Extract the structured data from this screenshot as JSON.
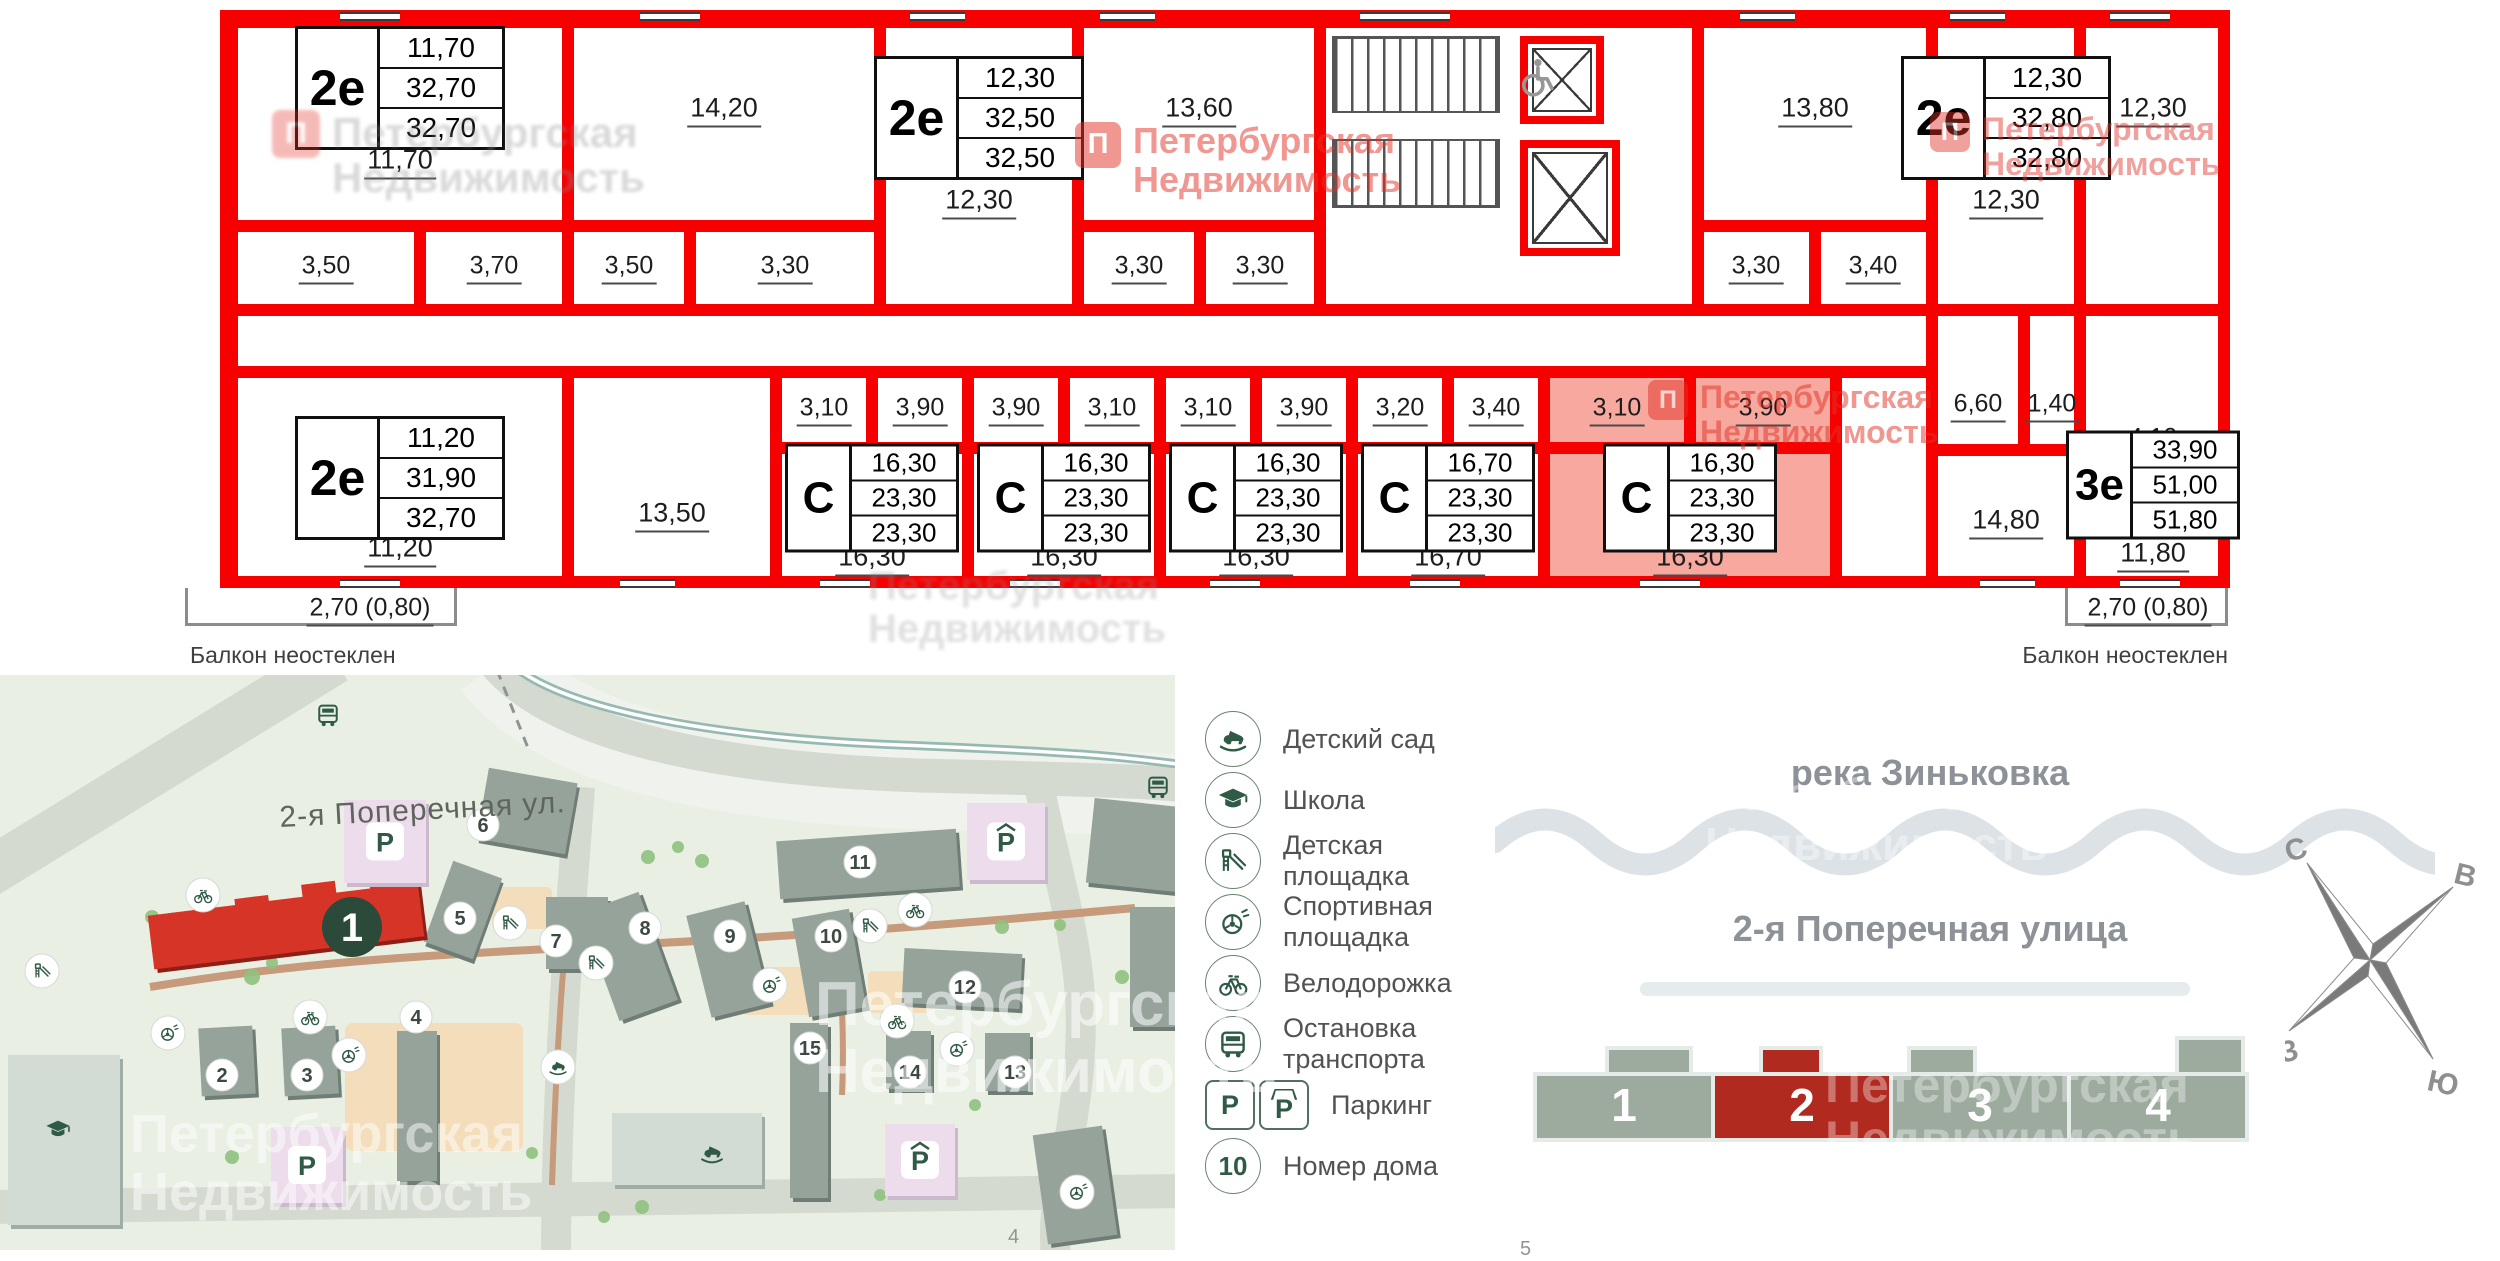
{
  "watermark": {
    "line1": "Петербургская",
    "line2": "Недвижимость",
    "logo_letter": "П"
  },
  "watermarks": [
    {
      "x": 1075,
      "y": 122,
      "style": "red",
      "size": 36,
      "logo": 46,
      "opacity": 0.5
    },
    {
      "x": 1930,
      "y": 112,
      "style": "red",
      "size": 32,
      "logo": 40,
      "opacity": 0.45
    },
    {
      "x": 1648,
      "y": 380,
      "style": "red",
      "size": 32,
      "logo": 40,
      "opacity": 0.5
    },
    {
      "x": 272,
      "y": 110,
      "style": "gray",
      "size": 42,
      "logo": 48,
      "opacity": 0.33
    },
    {
      "x": 868,
      "y": 565,
      "style": "gray",
      "size": 40,
      "logo": 0,
      "opacity": 0.27
    },
    {
      "x": 815,
      "y": 972,
      "style": "white",
      "size": 62,
      "logo": 0,
      "opacity": 0.55
    },
    {
      "x": 130,
      "y": 1105,
      "style": "white",
      "size": 54,
      "logo": 0,
      "opacity": 0.5
    },
    {
      "x": 1705,
      "y": 770,
      "style": "white",
      "size": 46,
      "logo": 0,
      "opacity": 0.4
    },
    {
      "x": 1825,
      "y": 1058,
      "style": "white",
      "size": 50,
      "logo": 0,
      "opacity": 0.35
    }
  ],
  "floorplan": {
    "wall_color": "#f60000",
    "highlight_fill": "#f7a89f",
    "cells": [
      {
        "x": 12,
        "y": 12,
        "w": 336,
        "h": 204,
        "name": "room-11-70"
      },
      {
        "x": 12,
        "y": 216,
        "w": 188,
        "h": 84,
        "name": "bath-3-50"
      },
      {
        "x": 200,
        "y": 216,
        "w": 148,
        "h": 84,
        "name": "hall-3-70"
      },
      {
        "x": 348,
        "y": 12,
        "w": 312,
        "h": 204,
        "name": "room-14-20"
      },
      {
        "x": 348,
        "y": 216,
        "w": 122,
        "h": 84,
        "name": "hall-3-50"
      },
      {
        "x": 470,
        "y": 216,
        "w": 190,
        "h": 84,
        "name": "bath-3-30"
      },
      {
        "x": 660,
        "y": 12,
        "w": 198,
        "h": 288,
        "name": "apt-2e-12-30",
        "apt": true
      },
      {
        "x": 858,
        "y": 12,
        "w": 242,
        "h": 204,
        "name": "room-13-60"
      },
      {
        "x": 858,
        "y": 216,
        "w": 122,
        "h": 84,
        "name": "hall-3-30"
      },
      {
        "x": 980,
        "y": 216,
        "w": 120,
        "h": 84,
        "name": "bath-3-30"
      },
      {
        "x": 1100,
        "y": 12,
        "w": 378,
        "h": 288,
        "name": "stairwell"
      },
      {
        "x": 1478,
        "y": 12,
        "w": 234,
        "h": 204,
        "name": "room-13-80"
      },
      {
        "x": 1478,
        "y": 216,
        "w": 117,
        "h": 84,
        "name": "bath-3-30"
      },
      {
        "x": 1595,
        "y": 216,
        "w": 117,
        "h": 84,
        "name": "hall-3-40"
      },
      {
        "x": 1712,
        "y": 12,
        "w": 148,
        "h": 288,
        "name": "apt-2e-12-30-right",
        "apt": true
      },
      {
        "x": 1860,
        "y": 12,
        "w": 146,
        "h": 288,
        "name": "room-12-30-right"
      },
      {
        "x": 12,
        "y": 300,
        "w": 1700,
        "h": 62,
        "name": "corridor"
      },
      {
        "x": 1712,
        "y": 300,
        "w": 92,
        "h": 140,
        "name": "kitchen-6-60"
      },
      {
        "x": 1804,
        "y": 300,
        "w": 56,
        "h": 140,
        "name": "wc-1-40"
      },
      {
        "x": 1860,
        "y": 300,
        "w": 146,
        "h": 140,
        "name": "bath-4-10"
      },
      {
        "x": 12,
        "y": 362,
        "w": 336,
        "h": 212,
        "name": "apt-2e-11-20",
        "apt": true
      },
      {
        "x": 348,
        "y": 362,
        "w": 208,
        "h": 212,
        "name": "room-13-50"
      },
      {
        "x": 556,
        "y": 362,
        "w": 96,
        "h": 76,
        "name": "hall-3-10"
      },
      {
        "x": 652,
        "y": 362,
        "w": 96,
        "h": 76,
        "name": "bath-3-90"
      },
      {
        "x": 556,
        "y": 438,
        "w": 192,
        "h": 136,
        "name": "studio-16-30-1",
        "apt": true
      },
      {
        "x": 748,
        "y": 362,
        "w": 96,
        "h": 76,
        "name": "bath-3-90"
      },
      {
        "x": 844,
        "y": 362,
        "w": 96,
        "h": 76,
        "name": "hall-3-10"
      },
      {
        "x": 748,
        "y": 438,
        "w": 192,
        "h": 136,
        "name": "studio-16-30-2",
        "apt": true
      },
      {
        "x": 940,
        "y": 362,
        "w": 96,
        "h": 76,
        "name": "hall-3-10"
      },
      {
        "x": 1036,
        "y": 362,
        "w": 96,
        "h": 76,
        "name": "bath-3-90"
      },
      {
        "x": 940,
        "y": 438,
        "w": 192,
        "h": 136,
        "name": "studio-16-30-3",
        "apt": true
      },
      {
        "x": 1132,
        "y": 362,
        "w": 96,
        "h": 76,
        "name": "bath-3-20"
      },
      {
        "x": 1228,
        "y": 362,
        "w": 96,
        "h": 76,
        "name": "hall-3-40"
      },
      {
        "x": 1132,
        "y": 438,
        "w": 192,
        "h": 136,
        "name": "studio-16-70",
        "apt": true
      },
      {
        "x": 1324,
        "y": 362,
        "w": 146,
        "h": 76,
        "hl": true,
        "name": "hall-3-10-selected"
      },
      {
        "x": 1470,
        "y": 362,
        "w": 146,
        "h": 76,
        "hl": true,
        "name": "bath-3-90-selected"
      },
      {
        "x": 1324,
        "y": 438,
        "w": 292,
        "h": 136,
        "hl": true,
        "name": "studio-16-30-selected",
        "apt": true
      },
      {
        "x": 1616,
        "y": 362,
        "w": 96,
        "h": 212,
        "name": "corridor-right"
      },
      {
        "x": 1712,
        "y": 440,
        "w": 148,
        "h": 134,
        "name": "room-14-80"
      },
      {
        "x": 1860,
        "y": 440,
        "w": 146,
        "h": 134,
        "name": "room-11-80"
      }
    ],
    "labels": [
      {
        "t": "11,70",
        "x": 180,
        "y": 152
      },
      {
        "t": "14,20",
        "x": 504,
        "y": 100
      },
      {
        "t": "12,30",
        "x": 759,
        "y": 192
      },
      {
        "t": "13,60",
        "x": 979,
        "y": 100
      },
      {
        "t": "13,80",
        "x": 1595,
        "y": 100
      },
      {
        "t": "12,30",
        "x": 1786,
        "y": 192
      },
      {
        "t": "12,30",
        "x": 1933,
        "y": 100
      },
      {
        "t": "3,50",
        "x": 106,
        "y": 258,
        "sm": true
      },
      {
        "t": "3,70",
        "x": 274,
        "y": 258,
        "sm": true
      },
      {
        "t": "3,50",
        "x": 409,
        "y": 258,
        "sm": true
      },
      {
        "t": "3,30",
        "x": 565,
        "y": 258,
        "sm": true
      },
      {
        "t": "3,30",
        "x": 919,
        "y": 258,
        "sm": true
      },
      {
        "t": "3,30",
        "x": 1040,
        "y": 258,
        "sm": true
      },
      {
        "t": "3,30",
        "x": 1536,
        "y": 258,
        "sm": true
      },
      {
        "t": "3,40",
        "x": 1653,
        "y": 258,
        "sm": true
      },
      {
        "t": "6,60",
        "x": 1758,
        "y": 396,
        "sm": true
      },
      {
        "t": "1,40",
        "x": 1832,
        "y": 396,
        "sm": true
      },
      {
        "t": "4,10",
        "x": 1933,
        "y": 430,
        "sm": true
      },
      {
        "t": "3,10",
        "x": 604,
        "y": 400,
        "sm": true
      },
      {
        "t": "3,90",
        "x": 700,
        "y": 400,
        "sm": true
      },
      {
        "t": "3,90",
        "x": 796,
        "y": 400,
        "sm": true
      },
      {
        "t": "3,10",
        "x": 892,
        "y": 400,
        "sm": true
      },
      {
        "t": "3,10",
        "x": 988,
        "y": 400,
        "sm": true
      },
      {
        "t": "3,90",
        "x": 1084,
        "y": 400,
        "sm": true
      },
      {
        "t": "3,20",
        "x": 1180,
        "y": 400,
        "sm": true
      },
      {
        "t": "3,40",
        "x": 1276,
        "y": 400,
        "sm": true
      },
      {
        "t": "3,10",
        "x": 1397,
        "y": 400,
        "sm": true
      },
      {
        "t": "3,90",
        "x": 1543,
        "y": 400,
        "sm": true
      },
      {
        "t": "11,20",
        "x": 180,
        "y": 540
      },
      {
        "t": "13,50",
        "x": 452,
        "y": 505
      },
      {
        "t": "16,30",
        "x": 652,
        "y": 549
      },
      {
        "t": "16,30",
        "x": 844,
        "y": 549
      },
      {
        "t": "16,30",
        "x": 1036,
        "y": 549
      },
      {
        "t": "16,70",
        "x": 1228,
        "y": 549
      },
      {
        "t": "16,30",
        "x": 1470,
        "y": 549
      },
      {
        "t": "14,80",
        "x": 1786,
        "y": 512
      },
      {
        "t": "11,80",
        "x": 1933,
        "y": 545
      }
    ],
    "cards": [
      {
        "type": "2е",
        "values": [
          "11,70",
          "32,70",
          "32,70"
        ],
        "x": 180,
        "y": 78,
        "size": "lg"
      },
      {
        "type": "2е",
        "values": [
          "12,30",
          "32,50",
          "32,50"
        ],
        "x": 759,
        "y": 108,
        "size": "lg"
      },
      {
        "type": "2е",
        "values": [
          "12,30",
          "32,80",
          "32,80"
        ],
        "x": 1786,
        "y": 108,
        "size": "lg"
      },
      {
        "type": "2е",
        "values": [
          "11,20",
          "31,90",
          "32,70"
        ],
        "x": 180,
        "y": 468,
        "size": "lg"
      },
      {
        "type": "С",
        "values": [
          "16,30",
          "23,30",
          "23,30"
        ],
        "x": 652,
        "y": 488,
        "size": "sm"
      },
      {
        "type": "С",
        "values": [
          "16,30",
          "23,30",
          "23,30"
        ],
        "x": 844,
        "y": 488,
        "size": "sm"
      },
      {
        "type": "С",
        "values": [
          "16,30",
          "23,30",
          "23,30"
        ],
        "x": 1036,
        "y": 488,
        "size": "sm"
      },
      {
        "type": "С",
        "values": [
          "16,70",
          "23,30",
          "23,30"
        ],
        "x": 1228,
        "y": 488,
        "size": "sm"
      },
      {
        "type": "С",
        "values": [
          "16,30",
          "23,30",
          "23,30"
        ],
        "x": 1470,
        "y": 488,
        "size": "sm"
      },
      {
        "type": "3е",
        "values": [
          "33,90",
          "51,00",
          "51,80"
        ],
        "x": 1933,
        "y": 475,
        "size": "sm"
      }
    ],
    "balcony_left": {
      "size": "2,70 (0,80)",
      "note": "Балкон неостеклен"
    },
    "balcony_right": {
      "size": "2,70 (0,80)",
      "note": "Балкон неостеклен"
    }
  },
  "map": {
    "street_label": "2-я Поперечная ул.",
    "sheet_number": "4",
    "parking_letter": "P",
    "red_building": {
      "label": "1"
    },
    "house_numbers": [
      {
        "n": "2",
        "x": 222,
        "y": 400
      },
      {
        "n": "3",
        "x": 307,
        "y": 400
      },
      {
        "n": "4",
        "x": 416,
        "y": 342
      },
      {
        "n": "5",
        "x": 460,
        "y": 243
      },
      {
        "n": "6",
        "x": 483,
        "y": 150
      },
      {
        "n": "7",
        "x": 556,
        "y": 266
      },
      {
        "n": "8",
        "x": 645,
        "y": 253
      },
      {
        "n": "9",
        "x": 730,
        "y": 261
      },
      {
        "n": "10",
        "x": 831,
        "y": 261
      },
      {
        "n": "11",
        "x": 860,
        "y": 187
      },
      {
        "n": "12",
        "x": 965,
        "y": 312
      },
      {
        "n": "13",
        "x": 1015,
        "y": 397
      },
      {
        "n": "14",
        "x": 910,
        "y": 397
      },
      {
        "n": "15",
        "x": 810,
        "y": 373
      }
    ],
    "buildings": [
      {
        "x": 200,
        "y": 352,
        "w": 54,
        "h": 68,
        "r": -3
      },
      {
        "x": 283,
        "y": 352,
        "w": 54,
        "h": 68,
        "r": -3
      },
      {
        "x": 397,
        "y": 356,
        "w": 40,
        "h": 150,
        "r": 0
      },
      {
        "x": 437,
        "y": 192,
        "w": 52,
        "h": 86,
        "r": 20
      },
      {
        "x": 482,
        "y": 100,
        "w": 90,
        "h": 72,
        "r": 10
      },
      {
        "x": 546,
        "y": 222,
        "w": 62,
        "h": 72,
        "r": 0
      },
      {
        "x": 598,
        "y": 224,
        "w": 62,
        "h": 115,
        "r": -20
      },
      {
        "x": 698,
        "y": 232,
        "w": 60,
        "h": 105,
        "r": -14
      },
      {
        "x": 800,
        "y": 238,
        "w": 58,
        "h": 100,
        "r": -10
      },
      {
        "x": 778,
        "y": 160,
        "w": 180,
        "h": 58,
        "r": -4
      },
      {
        "x": 903,
        "y": 276,
        "w": 118,
        "h": 55,
        "r": 3
      },
      {
        "x": 985,
        "y": 358,
        "w": 45,
        "h": 58,
        "r": 0
      },
      {
        "x": 886,
        "y": 356,
        "w": 45,
        "h": 58,
        "r": 0
      },
      {
        "x": 790,
        "y": 348,
        "w": 38,
        "h": 175,
        "r": 0
      },
      {
        "x": 1090,
        "y": 128,
        "w": 100,
        "h": 85,
        "r": 6
      },
      {
        "x": 1130,
        "y": 232,
        "w": 60,
        "h": 120,
        "r": 0
      },
      {
        "x": 1040,
        "y": 455,
        "w": 70,
        "h": 110,
        "r": -8
      }
    ],
    "light_buildings": [
      {
        "x": 8,
        "y": 380,
        "w": 112,
        "h": 170
      },
      {
        "x": 612,
        "y": 438,
        "w": 150,
        "h": 72
      }
    ],
    "parkings": [
      {
        "x": 344,
        "y": 125,
        "w": 82,
        "h": 83,
        "hat": false
      },
      {
        "x": 271,
        "y": 452,
        "w": 72,
        "h": 76,
        "hat": false
      },
      {
        "x": 967,
        "y": 128,
        "w": 78,
        "h": 77,
        "hat": true
      },
      {
        "x": 885,
        "y": 449,
        "w": 70,
        "h": 72,
        "hat": true
      }
    ],
    "icons": [
      {
        "k": "slide",
        "x": 510,
        "y": 248
      },
      {
        "k": "slide",
        "x": 596,
        "y": 288
      },
      {
        "k": "slide",
        "x": 42,
        "y": 296
      },
      {
        "k": "slide",
        "x": 870,
        "y": 251
      },
      {
        "k": "ball",
        "x": 168,
        "y": 358
      },
      {
        "k": "ball",
        "x": 349,
        "y": 380
      },
      {
        "k": "ball",
        "x": 770,
        "y": 310
      },
      {
        "k": "ball",
        "x": 957,
        "y": 374
      },
      {
        "k": "ball",
        "x": 1077,
        "y": 517
      },
      {
        "k": "bike",
        "x": 915,
        "y": 235
      },
      {
        "k": "bike",
        "x": 897,
        "y": 346
      },
      {
        "k": "bike",
        "x": 310,
        "y": 342
      },
      {
        "k": "bike",
        "x": 203,
        "y": 220
      },
      {
        "k": "horse",
        "x": 558,
        "y": 392
      }
    ],
    "glyphs": [
      {
        "k": "bus",
        "x": 328,
        "y": 40
      },
      {
        "k": "bus",
        "x": 1158,
        "y": 112
      },
      {
        "k": "cap",
        "x": 58,
        "y": 455
      },
      {
        "k": "horse",
        "x": 712,
        "y": 478
      }
    ],
    "trees": [
      [
        252,
        302,
        8
      ],
      [
        272,
        288,
        6
      ],
      [
        648,
        182,
        7
      ],
      [
        678,
        172,
        6
      ],
      [
        702,
        186,
        7
      ],
      [
        152,
        242,
        7
      ],
      [
        958,
        292,
        6
      ],
      [
        1002,
        252,
        7
      ],
      [
        938,
        472,
        7
      ],
      [
        642,
        532,
        7
      ],
      [
        604,
        542,
        6
      ],
      [
        858,
        302,
        6
      ],
      [
        232,
        482,
        7
      ],
      [
        532,
        478,
        6
      ],
      [
        1122,
        302,
        7
      ],
      [
        418,
        186,
        6
      ],
      [
        300,
        250,
        5
      ],
      [
        975,
        430,
        6
      ],
      [
        880,
        520,
        6
      ],
      [
        1060,
        250,
        6
      ]
    ]
  },
  "legend": {
    "items": [
      {
        "icon": "horse",
        "label": "Детский сад"
      },
      {
        "icon": "cap",
        "label": "Школа"
      },
      {
        "icon": "slide",
        "label": "Детская площадка"
      },
      {
        "icon": "ball",
        "label": "Спортивная площадка"
      },
      {
        "icon": "bike",
        "label": "Велодорожка"
      },
      {
        "icon": "bus",
        "label": "Остановка транспорта"
      },
      {
        "icon": "pp",
        "label": "Паркинг"
      },
      {
        "icon": "num",
        "label": "Номер дома",
        "num": "10"
      }
    ]
  },
  "diagram": {
    "river_label": "река Зиньковка",
    "street_label": "2-я Поперечная улица",
    "sheet_number": "5",
    "section_color": "#9dab9f",
    "section_highlight_color": "#b12a20",
    "sections": [
      {
        "label": "1",
        "highlighted": false
      },
      {
        "label": "2",
        "highlighted": true
      },
      {
        "label": "3",
        "highlighted": false
      },
      {
        "label": "4",
        "highlighted": false
      }
    ]
  },
  "compass": {
    "north": "С",
    "east": "В",
    "west": "З",
    "south": "Ю"
  }
}
